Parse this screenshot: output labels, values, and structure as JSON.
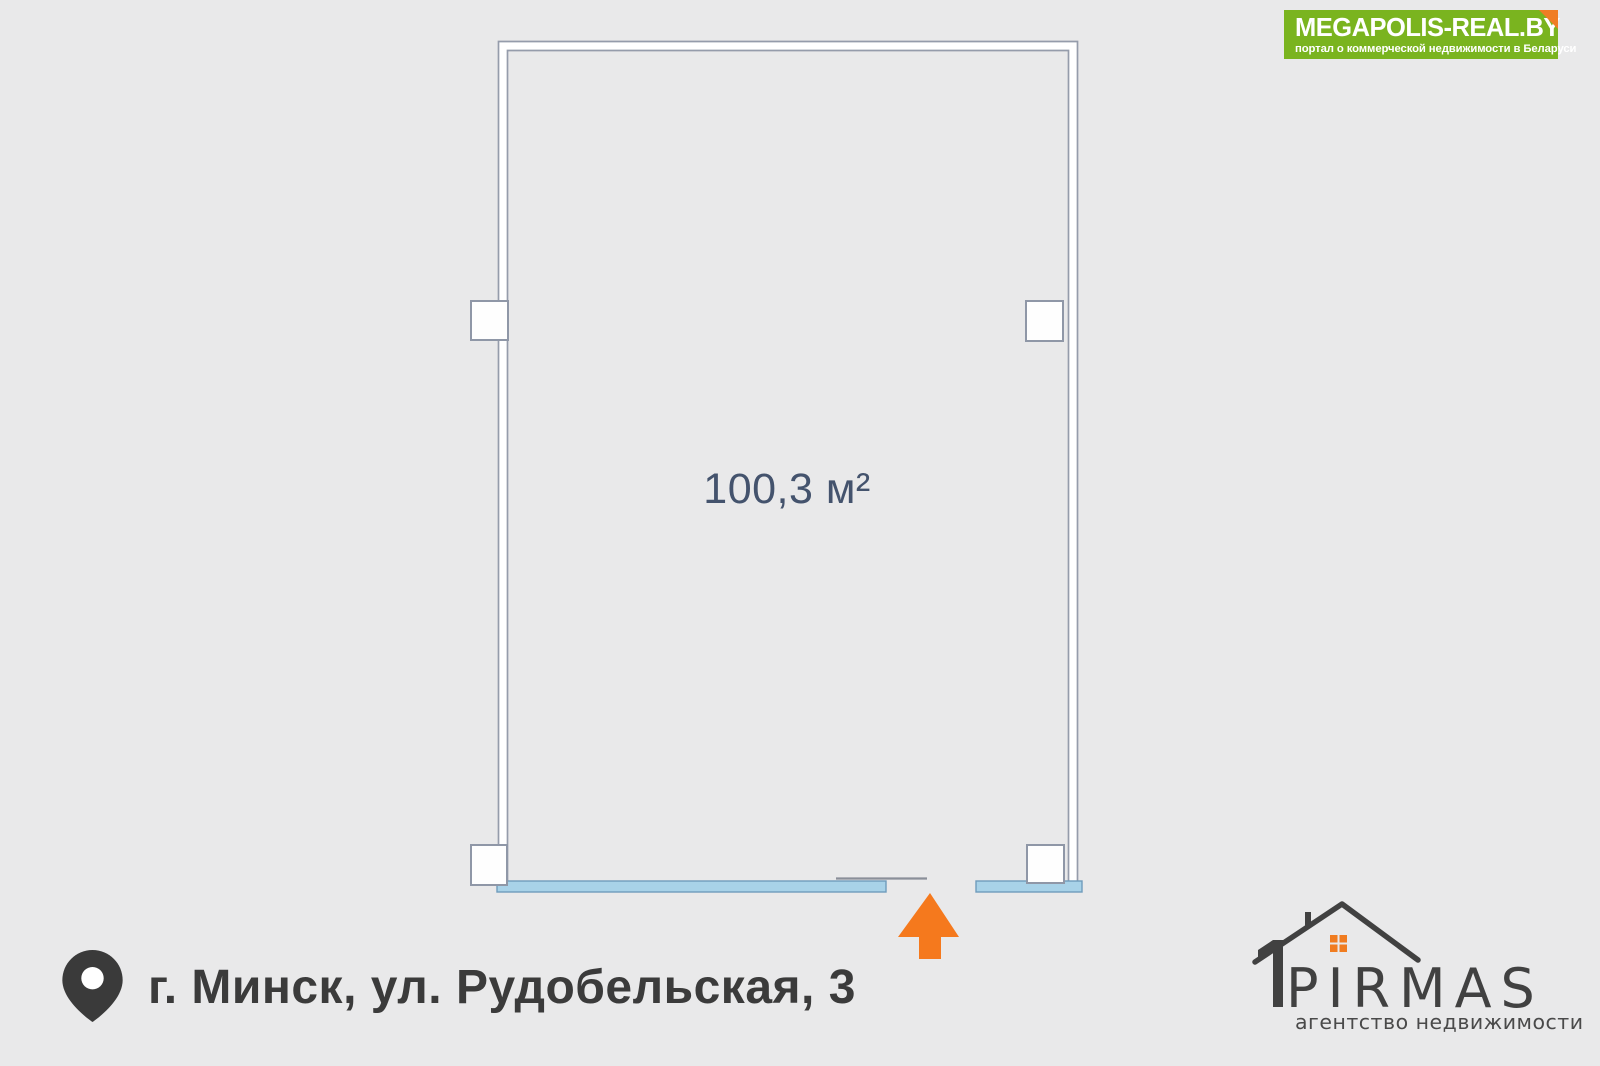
{
  "background_color": "#e9e9ea",
  "banner": {
    "title": "MEGAPOLIS-REAL.BY",
    "subtitle": "портал о коммерческой недвижимости в Беларуси",
    "bg_color": "#7ab41f",
    "fold_color": "#f07d24",
    "text_color": "#ffffff"
  },
  "floor_plan": {
    "area_label": "100,3 м²",
    "area_text_color": "#44536d",
    "wall_line_color": "#959cab",
    "wall_fill_color": "#ffffff",
    "window_band_fill": "#a8d2e8",
    "window_band_edge": "#6f9cbc",
    "door_line_color": "#8a8f99",
    "entrance_arrow_color": "#f5791d",
    "window_squares_count": 4
  },
  "address": {
    "text": "г. Минск, ул. Рудобельская, 3",
    "text_color": "#3b3b3b",
    "pin_color": "#3a3a3a"
  },
  "agency": {
    "name": "PIRMAS",
    "tagline": "агентство недвижимости",
    "logo_color": "#414141",
    "logo_accent_color": "#f07c20"
  }
}
